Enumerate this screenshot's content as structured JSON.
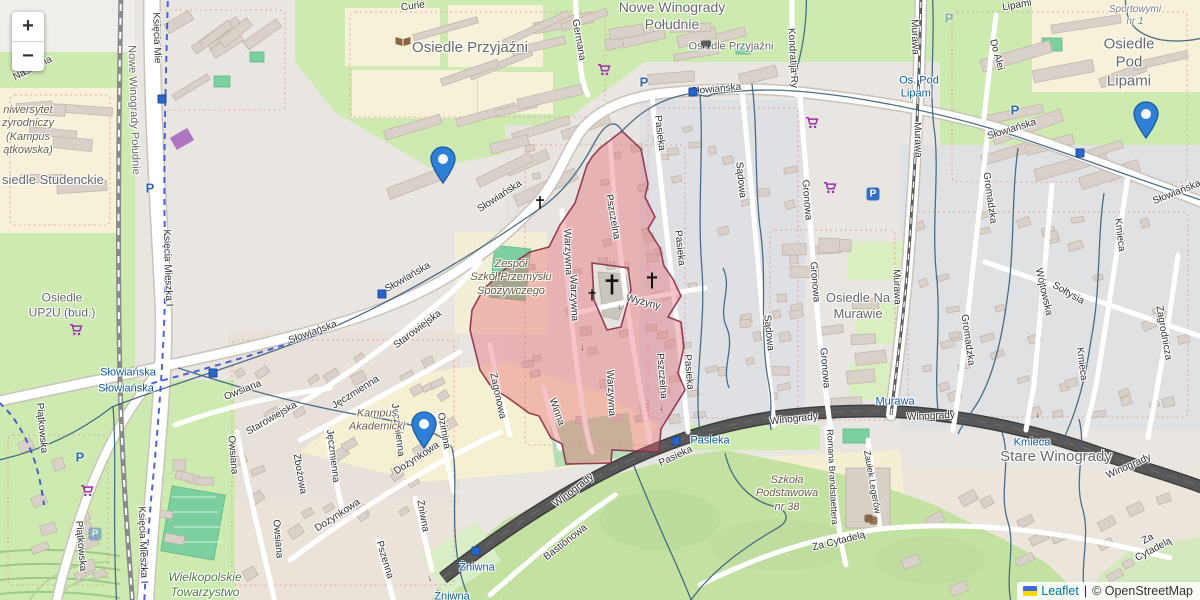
{
  "controls": {
    "zoom_in": "+",
    "zoom_out": "−"
  },
  "attribution": {
    "leaflet": "Leaflet",
    "separator": "|",
    "osm_copyright": "© OpenStreetMap",
    "flag_icon": "ukraine-flag"
  },
  "markers": [
    {
      "x": 443,
      "y": 183
    },
    {
      "x": 1146,
      "y": 138
    },
    {
      "x": 424,
      "y": 448
    }
  ],
  "labels": {
    "districts": [
      {
        "t": "Osiedle Przyjaźni",
        "x": 470,
        "y": 48,
        "fs": 15
      },
      {
        "t": "Nowe Winogrady\nPołudnie",
        "x": 672,
        "y": 16,
        "fs": 14
      },
      {
        "t": "Osiedle Przyjaźni",
        "x": 731,
        "y": 47,
        "fs": 11
      },
      {
        "t": "Osiedle Pod\nLipami",
        "x": 1129,
        "y": 63,
        "fs": 15
      },
      {
        "t": "Stare Winogrady",
        "x": 1056,
        "y": 457,
        "fs": 15
      },
      {
        "t": "Osiedle Na\nMurawie",
        "x": 858,
        "y": 306,
        "fs": 13
      },
      {
        "t": "siedle Studenckie",
        "x": 2,
        "y": 180,
        "fs": 13,
        "a": "left"
      },
      {
        "t": "Nowe Winogrady Południe",
        "x": 133,
        "y": 110,
        "fs": 11,
        "r": 88
      },
      {
        "t": "Osiedle\nUP2U (bud.)",
        "x": 62,
        "y": 305,
        "fs": 12
      }
    ],
    "streets": [
      {
        "t": "Słowiańska",
        "x": 500,
        "y": 197,
        "r": -33
      },
      {
        "t": "Słowiańska",
        "x": 408,
        "y": 278,
        "r": -30
      },
      {
        "t": "Słowiańska",
        "x": 313,
        "y": 333,
        "r": -20
      },
      {
        "t": "Słowiańska",
        "x": 716,
        "y": 90,
        "r": -5
      },
      {
        "t": "Słowiańska",
        "x": 1012,
        "y": 130,
        "r": -17
      },
      {
        "t": "Słowiańska",
        "x": 1177,
        "y": 193,
        "r": -22
      },
      {
        "t": "Starowiejska",
        "x": 418,
        "y": 330,
        "r": -37
      },
      {
        "t": "Starowiejska",
        "x": 272,
        "y": 419,
        "r": -30
      },
      {
        "t": "Pasieka",
        "x": 659,
        "y": 133,
        "r": 83
      },
      {
        "t": "Pasieka",
        "x": 679,
        "y": 248,
        "r": 84
      },
      {
        "t": "Pasieka",
        "x": 688,
        "y": 372,
        "r": 85
      },
      {
        "t": "Pasieka",
        "x": 676,
        "y": 457,
        "r": -25
      },
      {
        "t": "Sądowa",
        "x": 740,
        "y": 180,
        "r": 84
      },
      {
        "t": "Sądowa",
        "x": 768,
        "y": 333,
        "r": 84
      },
      {
        "t": "Gronowa",
        "x": 806,
        "y": 200,
        "r": 85
      },
      {
        "t": "Gronowa",
        "x": 814,
        "y": 282,
        "r": 85
      },
      {
        "t": "Gronowa",
        "x": 824,
        "y": 368,
        "r": 85
      },
      {
        "t": "Kondratija Ry",
        "x": 792,
        "y": 58,
        "r": 87
      },
      {
        "t": "Germana",
        "x": 578,
        "y": 40,
        "r": 80
      },
      {
        "t": "Murawa",
        "x": 914,
        "y": 37,
        "r": 88
      },
      {
        "t": "Murawa",
        "x": 917,
        "y": 140,
        "r": 88
      },
      {
        "t": "Murawa",
        "x": 896,
        "y": 287,
        "r": 88
      },
      {
        "t": "Do Alei",
        "x": 996,
        "y": 55,
        "r": 75
      },
      {
        "t": "Gromadzka",
        "x": 989,
        "y": 198,
        "r": 82
      },
      {
        "t": "Gromadzka",
        "x": 967,
        "y": 340,
        "r": 82
      },
      {
        "t": "Wójtowska",
        "x": 1043,
        "y": 292,
        "r": 77
      },
      {
        "t": "Sołtysia",
        "x": 1068,
        "y": 294,
        "r": 30
      },
      {
        "t": "Kmieca",
        "x": 1119,
        "y": 235,
        "r": 83
      },
      {
        "t": "Kmieca",
        "x": 1081,
        "y": 364,
        "r": 83
      },
      {
        "t": "Zagrodnicza",
        "x": 1163,
        "y": 333,
        "r": 80
      },
      {
        "t": "Pszczelna",
        "x": 612,
        "y": 217,
        "r": 80
      },
      {
        "t": "Pszczelna",
        "x": 661,
        "y": 376,
        "r": 85
      },
      {
        "t": "Warzywna",
        "x": 567,
        "y": 252,
        "r": 88
      },
      {
        "t": "Warzywna",
        "x": 573,
        "y": 298,
        "r": 88
      },
      {
        "t": "Warzywna",
        "x": 610,
        "y": 393,
        "r": 87
      },
      {
        "t": "Winna",
        "x": 556,
        "y": 412,
        "r": 70
      },
      {
        "t": "Wyżyny",
        "x": 643,
        "y": 303,
        "r": 15
      },
      {
        "t": "Zagonowa",
        "x": 497,
        "y": 396,
        "r": 78
      },
      {
        "t": "Zbożowa",
        "x": 299,
        "y": 474,
        "r": 80
      },
      {
        "t": "Jęczmienna",
        "x": 356,
        "y": 393,
        "r": -32
      },
      {
        "t": "Jęczmienna",
        "x": 332,
        "y": 456,
        "r": 83
      },
      {
        "t": "Jęczmienna",
        "x": 397,
        "y": 430,
        "r": 83
      },
      {
        "t": "Dożynkowa",
        "x": 417,
        "y": 459,
        "r": -33
      },
      {
        "t": "Dożynkowa",
        "x": 338,
        "y": 516,
        "r": -33
      },
      {
        "t": "Pszenna",
        "x": 384,
        "y": 560,
        "r": 73
      },
      {
        "t": "Żniwna",
        "x": 422,
        "y": 516,
        "r": 80
      },
      {
        "t": "Bastionowa",
        "x": 566,
        "y": 543,
        "r": -38
      },
      {
        "t": "Winogrady",
        "x": 574,
        "y": 491,
        "r": -38
      },
      {
        "t": "Winogrady",
        "x": 794,
        "y": 420,
        "r": -6
      },
      {
        "t": "Winogrady",
        "x": 931,
        "y": 417,
        "r": -3
      },
      {
        "t": "Winogrady",
        "x": 1129,
        "y": 467,
        "r": -24
      },
      {
        "t": "Za Cytadelą",
        "x": 839,
        "y": 542,
        "r": -14
      },
      {
        "t": "Za Cytadelą",
        "x": 1151,
        "y": 545,
        "r": -28
      },
      {
        "t": "Romana Brandstaettera",
        "x": 832,
        "y": 477,
        "r": 87,
        "fs": 9
      },
      {
        "t": "Zaułek Legerów",
        "x": 872,
        "y": 482,
        "r": 80,
        "fs": 9
      },
      {
        "t": "Księcia Mie",
        "x": 156,
        "y": 38,
        "r": 88
      },
      {
        "t": "Księcia Mieszka I",
        "x": 167,
        "y": 268,
        "r": 88
      },
      {
        "t": "Księcia Mieszka I",
        "x": 142,
        "y": 545,
        "r": 88
      },
      {
        "t": "Piątkowska",
        "x": 41,
        "y": 428,
        "r": 85
      },
      {
        "t": "Piątkowska",
        "x": 80,
        "y": 546,
        "r": 85
      },
      {
        "t": "Owsiana",
        "x": 243,
        "y": 391,
        "r": -22
      },
      {
        "t": "Owsiana",
        "x": 232,
        "y": 455,
        "r": 85
      },
      {
        "t": "Owsiana",
        "x": 277,
        "y": 539,
        "r": 85
      },
      {
        "t": "Ozimina",
        "x": 443,
        "y": 431,
        "r": 80
      },
      {
        "t": "Nasienna",
        "x": 33,
        "y": 69,
        "r": -27
      },
      {
        "t": "Curie",
        "x": 413,
        "y": 7,
        "r": -8
      },
      {
        "t": "Lipami",
        "x": 1017,
        "y": 6,
        "r": -10
      }
    ],
    "transit": [
      {
        "t": "Słowiańska",
        "x": 128,
        "y": 373
      },
      {
        "t": "Słowiańska",
        "x": 126,
        "y": 389
      },
      {
        "t": "Os. Pod",
        "x": 919,
        "y": 81
      },
      {
        "t": "Lipami",
        "x": 917,
        "y": 94
      },
      {
        "t": "Pasieka",
        "x": 710,
        "y": 441
      },
      {
        "t": "Żniwna",
        "x": 477,
        "y": 568
      },
      {
        "t": "Żniwna",
        "x": 452,
        "y": 597
      },
      {
        "t": "Kmieca",
        "x": 1032,
        "y": 443
      },
      {
        "t": "Murawa",
        "x": 895,
        "y": 402
      }
    ],
    "areas": [
      {
        "t": "Zespół\nSzkół Przemysłu\nSpożywczego",
        "x": 511,
        "y": 278,
        "cls": "a-school"
      },
      {
        "t": "Szkoła\nPodstawowa\nnr 38",
        "x": 787,
        "y": 494,
        "cls": "a-school"
      },
      {
        "t": "Kampus\nAkademicki",
        "x": 377,
        "y": 421,
        "cls": "a-school"
      },
      {
        "t": "niwersytet\nzyrodniczy\n(Kampus\nątkowska)",
        "x": 2,
        "y": 131,
        "cls": "a-school",
        "a": "left"
      },
      {
        "t": "Wielkopolskie\nTowarzystwo\nKrzewienia",
        "x": 205,
        "y": 592,
        "cls": "a-green"
      },
      {
        "t": "Sportowymi\nnr 1",
        "x": 1135,
        "y": 16,
        "cls": "a-gray",
        "fs": 10
      }
    ]
  },
  "icons": {
    "parking_glyph": "P",
    "arrow_glyph": "→",
    "parking_plain": [
      {
        "x": 150,
        "y": 188
      },
      {
        "x": 644,
        "y": 82
      },
      {
        "x": 1015,
        "y": 110
      },
      {
        "x": 80,
        "y": 457
      },
      {
        "x": 949,
        "y": 18,
        "faded": true
      }
    ],
    "parking_boxed": [
      {
        "x": 873,
        "y": 194
      },
      {
        "x": 95,
        "y": 534,
        "faded": true
      }
    ],
    "supermarket": [
      {
        "x": 604,
        "y": 72
      },
      {
        "x": 812,
        "y": 125
      },
      {
        "x": 830,
        "y": 190
      },
      {
        "x": 76,
        "y": 332
      },
      {
        "x": 87,
        "y": 493
      }
    ],
    "transit_stop": [
      {
        "x": 162,
        "y": 99
      },
      {
        "x": 693,
        "y": 92
      },
      {
        "x": 1080,
        "y": 153
      },
      {
        "x": 382,
        "y": 294
      },
      {
        "x": 213,
        "y": 373
      },
      {
        "x": 676,
        "y": 441
      },
      {
        "x": 476,
        "y": 551
      }
    ],
    "cross": [
      {
        "x": 540,
        "y": 205,
        "s": 9
      },
      {
        "x": 612,
        "y": 287,
        "s": 16
      },
      {
        "x": 652,
        "y": 283,
        "s": 12
      },
      {
        "x": 592,
        "y": 297,
        "s": 8
      }
    ],
    "library_book": {
      "x": 403,
      "y": 43
    },
    "bus_stop": {
      "x": 706,
      "y": 44
    },
    "theatre": {
      "x": 871,
      "y": 521
    },
    "oneway_arrows": [
      {
        "x": 663,
        "y": 408,
        "r": 85
      },
      {
        "x": 584,
        "y": 348,
        "r": 87
      },
      {
        "x": 621,
        "y": 307,
        "r": 80
      },
      {
        "x": 431,
        "y": 578,
        "r": 72
      },
      {
        "x": 560,
        "y": 540,
        "r": -38
      },
      {
        "x": 1039,
        "y": 415,
        "r": 77
      }
    ]
  },
  "overlay_colors": {
    "zone_fill": "#e4626f",
    "zone_border": "#8a2f46",
    "boundary_line": "#38607c",
    "route_dashed": "#2f48d0",
    "marker_blue": "#2e7fd6"
  }
}
